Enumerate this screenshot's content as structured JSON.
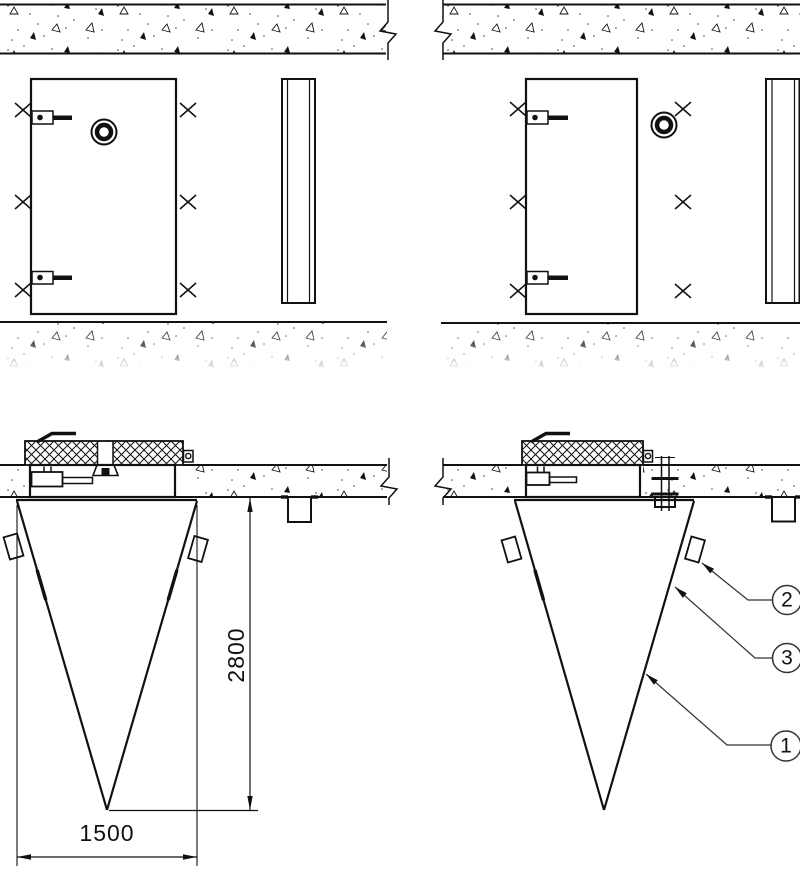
{
  "drawing": {
    "background_color": "#ffffff",
    "line_color": "#111111",
    "dimensions": {
      "cone_height_mm": "2800",
      "cone_width_mm": "1500"
    },
    "callouts": [
      {
        "number": "2"
      },
      {
        "number": "3"
      },
      {
        "number": "1"
      }
    ]
  }
}
